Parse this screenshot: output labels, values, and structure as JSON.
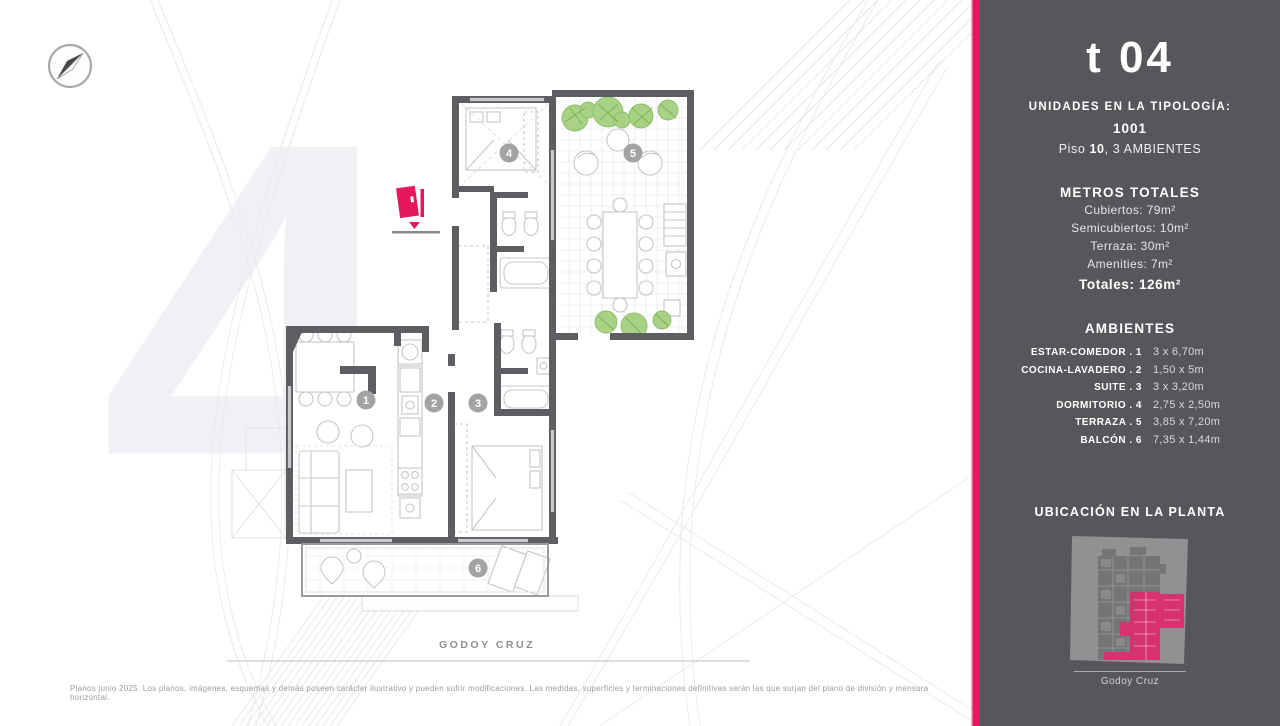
{
  "page": {
    "street_label": "GODOY CRUZ",
    "disclaimer": "Planos junio 2025. Los planos, imágenes, esquemas y demás poseen carácter ilustrativo y pueden sufrir modificaciones. Las medidas, superficies y terminaciones definitivas serán las que surjan del plano de división y mensura horizontal."
  },
  "plan": {
    "room_numbers": [
      "1",
      "2",
      "3",
      "4",
      "5",
      "6"
    ],
    "watermark_numeral": "4"
  },
  "sidebar": {
    "title": "t 04",
    "units_heading": "UNIDADES EN LA TIPOLOGÍA:",
    "unit_number": "1001",
    "floor_label": "Piso ",
    "floor_number": "10",
    "floor_rest": ",  3 AMBIENTES",
    "metros": {
      "heading": "METROS TOTALES",
      "rows": [
        "Cubiertos: 79m²",
        "Semicubiertos: 10m²",
        "Terraza: 30m²",
        "Amenities: 7m²"
      ],
      "total": "Totales: 126m²"
    },
    "ambientes": {
      "heading": "AMBIENTES",
      "rows": [
        {
          "label": "ESTAR-COMEDOR . 1",
          "value": "3 x 6,70m"
        },
        {
          "label": "COCINA-LAVADERO . 2",
          "value": "1,50 x 5m"
        },
        {
          "label": "SUITE . 3",
          "value": "3 x 3,20m"
        },
        {
          "label": "DORMITORIO . 4",
          "value": "2,75 x 2,50m"
        },
        {
          "label": "TERRAZA . 5",
          "value": "3,85 x 7,20m"
        },
        {
          "label": "BALCÓN . 6",
          "value": "7,35 x 1,44m"
        }
      ]
    },
    "ubicacion": {
      "heading": "UBICACIÓN EN LA PLANTA",
      "street": "Godoy Cruz"
    }
  },
  "colors": {
    "accent": "#E6175F",
    "sidebar_bg": "#57575B",
    "wall_gray": "#5E5E62",
    "plant_green": "#97CA6D",
    "watermark_gray": "#F0F1F4"
  }
}
